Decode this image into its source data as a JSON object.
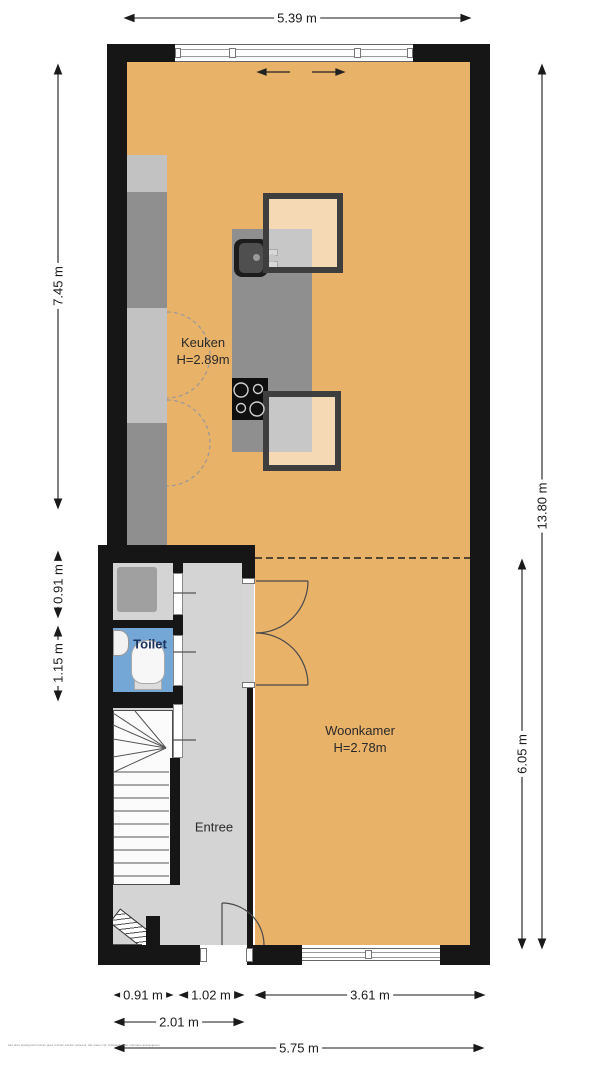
{
  "plan_title": "Begane grond plattegrond",
  "dims": {
    "top": "5.39 m",
    "left_total": "7.45 m",
    "left_closet": "0.91 m",
    "left_toilet": "1.15 m",
    "right_total": "13.80 m",
    "right_living": "6.05 m",
    "bottom_rooms": "0.91 m",
    "bottom_hall": "1.02 m",
    "bottom_living": "3.61 m",
    "bottom_combined": "2.01 m",
    "bottom_total": "5.75 m"
  },
  "rooms": {
    "keuken": {
      "label": "Keuken",
      "height": "H=2.89m"
    },
    "woonkamer": {
      "label": "Woonkamer",
      "height": "H=2.78m"
    },
    "entree": {
      "label": "Entree"
    },
    "toilet": {
      "label": "Toilet"
    }
  },
  "colors": {
    "floor_wood": "#e9b269",
    "floor_hall": "#d4d4d4",
    "floor_toilet": "#74a7d6",
    "wall": "#161616",
    "counter_dark": "#8f8f8f",
    "counter_light": "#c2c2c2",
    "toilet_label": "#1d3461"
  },
  "disclaimer": "Aan deze plattegrond kunnen geen rechten worden ontleend, alle maten zijn indicatief en ter orientatie weergegeven."
}
